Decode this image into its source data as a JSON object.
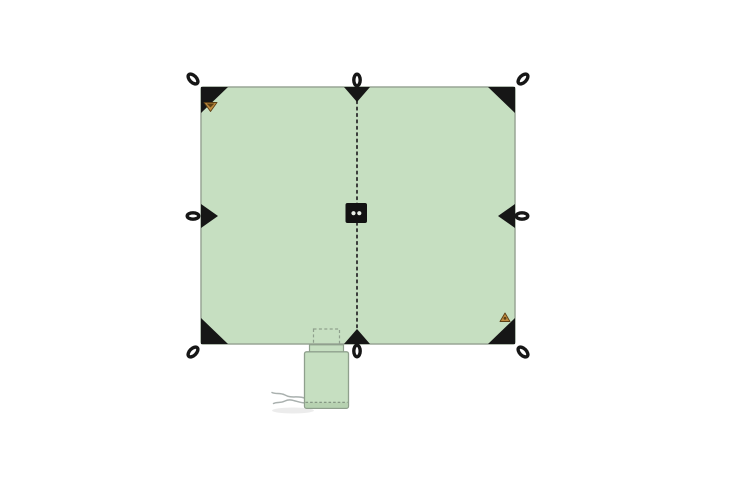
{
  "page": {
    "background": "#ffffff"
  },
  "illustration": {
    "type": "product-diagram",
    "subject": "square tarp top view with eight reinforced tie-out loops, dotted center ridge seam, center brand patch, two small brand logos and a packed stuff sack with drawcord",
    "colors": {
      "tarp_fill": "#c6dfc1",
      "tarp_border": "#98a596",
      "hardware": "#161616",
      "seam": "#2d2d2d",
      "patch": "#121212",
      "patch_dots": "#e9efe7",
      "logo_tan": "#bf8b3f",
      "logo_dark": "#5c4016",
      "sack_fill": "#c6dfc1",
      "sack_border": "#8fa08d",
      "sack_bottom": "#b7d2b1",
      "sack_hem": "#7f907d",
      "flap_dash": "#8fa08d",
      "cord": "#a9b0ae",
      "shadow": "#ececec"
    },
    "components": {
      "tarp_panel": "tarp-panel",
      "center_seam": "center-seam-dotted-line",
      "center_patch": "center-brand-patch",
      "tie_points": [
        "top-left",
        "top-center",
        "top-right",
        "left-center",
        "right-center",
        "bottom-left",
        "bottom-center",
        "bottom-right"
      ],
      "brand_logos": [
        "top-left-brand-logo",
        "bottom-right-brand-logo"
      ],
      "stuff_sack": "packed-stuff-sack-with-drawcord"
    }
  }
}
